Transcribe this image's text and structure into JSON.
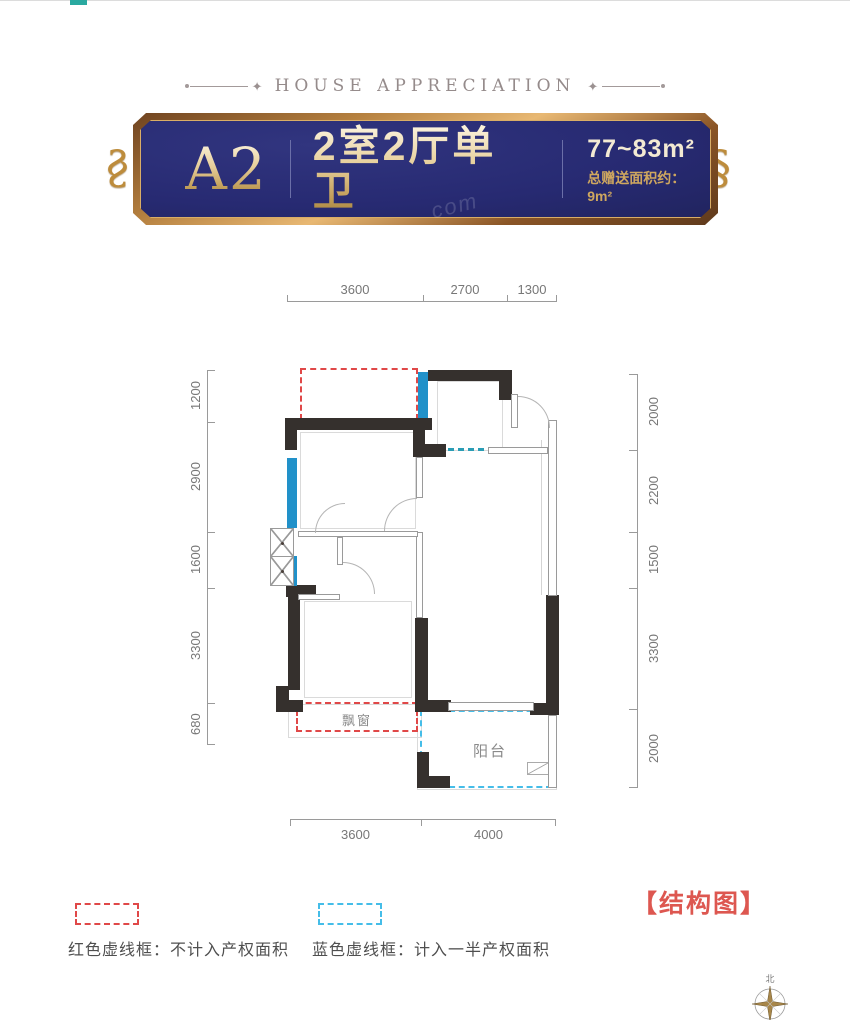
{
  "header": {
    "title": "HOUSE APPRECIATION"
  },
  "banner": {
    "unit": "A2",
    "layout": "2室2厅单卫",
    "area_range": "77~83m²",
    "bonus_area": "总赠送面积约：9m²",
    "bg_color": "#272a72",
    "frame_color": "#c98f4e",
    "watermark": "com"
  },
  "floorplan": {
    "dimensions": {
      "top": [
        "3600",
        "2700",
        "1300"
      ],
      "bottom": [
        "3600",
        "4000"
      ],
      "left": [
        "1200",
        "2900",
        "1600",
        "3300",
        "680"
      ],
      "right": [
        "2000",
        "2200",
        "1500",
        "3300",
        "2000"
      ]
    },
    "labels": {
      "bay_window": "飘窗",
      "balcony": "阳台"
    },
    "colors": {
      "wall": "#35302d",
      "window": "#2191c9",
      "red_dash": "#e04848",
      "blue_dash": "#45bde8"
    }
  },
  "legend": {
    "red_item": "红色虚线框：不计入产权面积",
    "blue_item": "蓝色虚线框：计入一半产权面积",
    "structure_tag": "【结构图】"
  },
  "compass": {
    "north": "北"
  }
}
